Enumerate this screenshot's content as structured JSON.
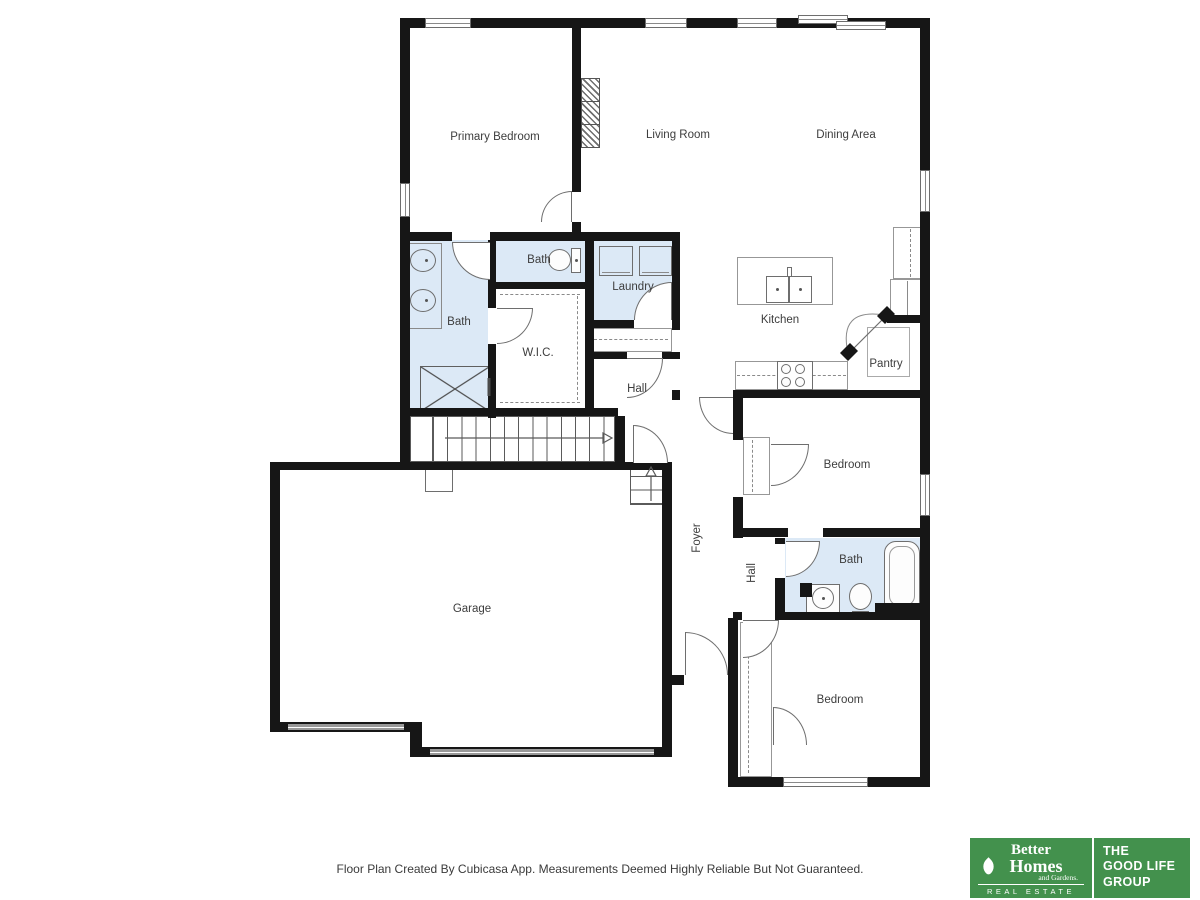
{
  "labels": {
    "primary_bedroom": "Primary Bedroom",
    "living_room": "Living Room",
    "dining_area": "Dining Area",
    "bath_ensuite": "Bath",
    "bath_hall": "Bath",
    "laundry": "Laundry",
    "wic": "W.I.C.",
    "hall_upper": "Hall",
    "kitchen": "Kitchen",
    "pantry": "Pantry",
    "bedroom_1": "Bedroom",
    "foyer": "Foyer",
    "hall_lower": "Hall",
    "bath_lower": "Bath",
    "garage": "Garage",
    "bedroom_2": "Bedroom"
  },
  "footer": {
    "disclaimer": "Floor Plan Created By Cubicasa App. Measurements Deemed Highly Reliable But Not Guaranteed."
  },
  "logo": {
    "brand_line1": "Better",
    "brand_line2": "Homes",
    "brand_line3": "and Gardens.",
    "brand_sub": "REAL ESTATE",
    "group_line1": "THE",
    "group_line2": "GOOD LIFE",
    "group_line3": "GROUP"
  },
  "colors": {
    "wall": "#161616",
    "wet_room_fill": "#dce9f6",
    "logo_green": "#43914d",
    "line": "#6e6e6e"
  }
}
